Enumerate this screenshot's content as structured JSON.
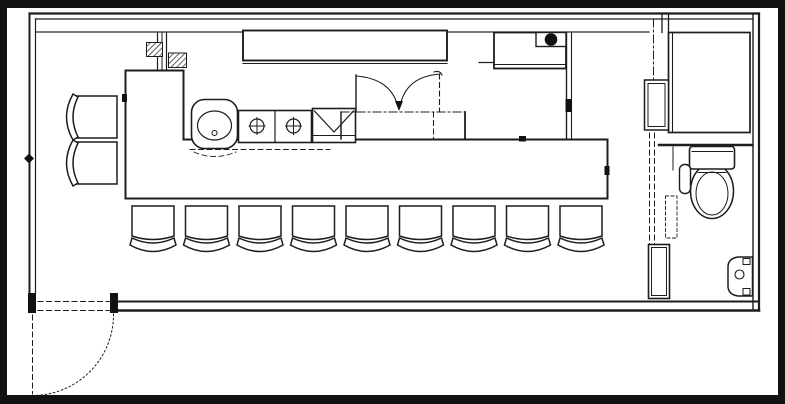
{
  "meta": {
    "title": "restaurant-floor-plan",
    "description": "Scanned black-and-white floor plan of a small counter-service restaurant with an L-shaped bar counter, kitchen line, WC, storage closet and outward-swinging entrance door",
    "drawing_style": "hand-drafted scan, black ink on white paper, thick black page frame"
  },
  "colors": {
    "ink": "#1d1d1d",
    "paper": "#ffffff",
    "frame": "#000000",
    "hatch": "#444444"
  },
  "plan": {
    "rooms": [
      {
        "name": "dining-area",
        "position": "left and bottom, around the bar counter"
      },
      {
        "name": "kitchen",
        "position": "center-top, inside the L-shaped counter"
      },
      {
        "name": "wc",
        "position": "bottom-right"
      },
      {
        "name": "storage-closet",
        "position": "top-right corner"
      }
    ],
    "seating": {
      "bar_stools_front_row": 9,
      "side_chairs_left": 2
    },
    "fixtures": [
      {
        "name": "bar-counter",
        "shape": "L-shaped island counter"
      },
      {
        "name": "back-counter",
        "position": "against top wall"
      },
      {
        "name": "hand-wash-basin",
        "symbol": "rounded square with oval bowl and drain dot"
      },
      {
        "name": "two-compartment-sink",
        "basins": 2,
        "symbol": "squares with crossed-circle drains"
      },
      {
        "name": "drainboard-unit",
        "symbol": "box with V lines"
      },
      {
        "name": "under-counter-double-door-unit",
        "doors": 2,
        "symbol": "two quarter-swing arcs meeting at arrow"
      },
      {
        "name": "equipment-with-burner-dot",
        "symbol": "box with solid black circle"
      },
      {
        "name": "hatched-wall-pier",
        "symbol": "cross-hatched masonry blocks"
      },
      {
        "name": "wc-toilet",
        "parts": [
          "tank",
          "bowl",
          "flush-handle"
        ]
      },
      {
        "name": "wc-wall-basin",
        "position": "right wall of WC"
      },
      {
        "name": "wc-entry-cabinet",
        "position": "left of WC door"
      },
      {
        "name": "vestibule-door-panel",
        "position": "left of storage closet"
      },
      {
        "name": "entrance-door",
        "swing": "quarter-arc outward",
        "position": "bottom-left"
      }
    ]
  }
}
